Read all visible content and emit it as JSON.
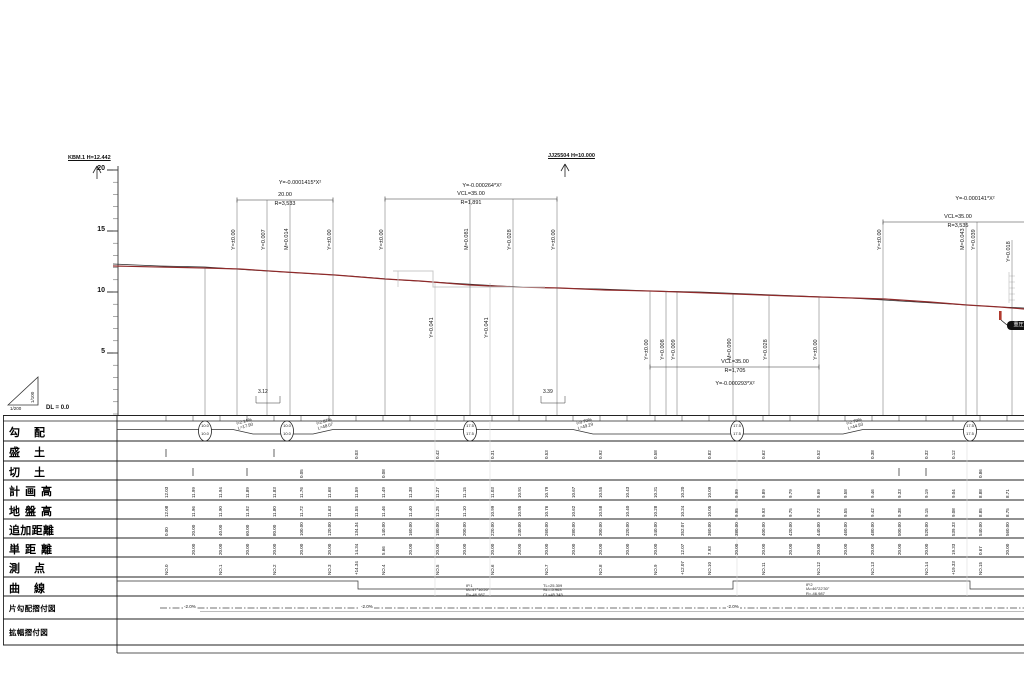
{
  "axis": {
    "dl_label": "DL = 0.0",
    "unit_ticks": [
      {
        "label": "20",
        "y": 170
      },
      {
        "label": "15",
        "y": 231
      },
      {
        "label": "10",
        "y": 292
      },
      {
        "label": "5",
        "y": 353
      }
    ],
    "scale_vertical": "1/100",
    "scale_horizontal": "1/200"
  },
  "benchmarks": [
    {
      "text": "KBM.1 H=12.442",
      "x": 68,
      "y": 155,
      "sym_x": 97
    },
    {
      "text": "JJ25504 H=10.000",
      "x": 548,
      "y": 153,
      "sym_x": 565
    }
  ],
  "curve_groups": [
    {
      "formula": "Y=-0.0001415*X²",
      "len_label": "20.00",
      "radius_label": "R=3,533",
      "cx": 285,
      "formula_x": 300,
      "formula_y": 180,
      "dim_y": 200,
      "x1": 237,
      "x2": 333
    },
    {
      "formula": "Y=-0.000264*X²",
      "len_label": "VCL=35.00",
      "radius_label": "R=1,891",
      "cx": 471,
      "formula_x": 482,
      "formula_y": 183,
      "dim_y": 199,
      "x1": 385,
      "x2": 557
    },
    {
      "formula": "Y=-0.000293*X²",
      "len_label": "VCL=35.00",
      "radius_label": "R=1,705",
      "cx": 735,
      "formula_x": 735,
      "formula_y": 381,
      "dim_y": 367,
      "x1": 650,
      "x2": 819
    },
    {
      "formula": "Y=-0.000141*X²",
      "len_label": "VCL=35.00",
      "radius_label": "R=3,535",
      "cx": 958,
      "formula_x": 975,
      "formula_y": 196,
      "dim_y": 222,
      "x1": 883,
      "x2": 1026
    }
  ],
  "rotated_labels": [
    {
      "x": 237,
      "y": 250,
      "text": "Y=±0.00"
    },
    {
      "x": 267,
      "y": 250,
      "text": "Y=0.007"
    },
    {
      "x": 290,
      "y": 250,
      "text": "M=0.014"
    },
    {
      "x": 333,
      "y": 250,
      "text": "Y=±0.00"
    },
    {
      "x": 385,
      "y": 250,
      "text": "Y=±0.00"
    },
    {
      "x": 470,
      "y": 250,
      "text": "M=0.081"
    },
    {
      "x": 513,
      "y": 250,
      "text": "Y=0.028"
    },
    {
      "x": 557,
      "y": 250,
      "text": "Y=±0.00"
    },
    {
      "x": 435,
      "y": 338,
      "text": "Y=0.041"
    },
    {
      "x": 490,
      "y": 338,
      "text": "Y=0.041"
    },
    {
      "x": 650,
      "y": 360,
      "text": "Y=±0.00"
    },
    {
      "x": 666,
      "y": 360,
      "text": "Y=0.008"
    },
    {
      "x": 677,
      "y": 360,
      "text": "Y=0.009"
    },
    {
      "x": 733,
      "y": 360,
      "text": "M=0.090"
    },
    {
      "x": 769,
      "y": 360,
      "text": "Y=0.028"
    },
    {
      "x": 819,
      "y": 360,
      "text": "Y=±0.00"
    },
    {
      "x": 883,
      "y": 250,
      "text": "Y=±0.00"
    },
    {
      "x": 966,
      "y": 250,
      "text": "M=0.043"
    },
    {
      "x": 977,
      "y": 250,
      "text": "Y=0.039"
    },
    {
      "x": 1012,
      "y": 262,
      "text": "Y=0.018"
    }
  ],
  "depth_marks": [
    {
      "x": 258,
      "y": 389,
      "text": "3.12",
      "x1": 256,
      "x2": 280
    },
    {
      "x": 543,
      "y": 389,
      "text": "3.39",
      "x1": 541,
      "x2": 565
    }
  ],
  "pipe_label": "重圧管",
  "table": {
    "row_labels": [
      "勾配",
      "盛土",
      "切土",
      "計画高",
      "地盤高",
      "追加距離",
      "単距離",
      "測点",
      "曲線",
      "片勾配摺付図",
      "拡幅摺付図"
    ],
    "gradient_ovals": [
      {
        "x": 205,
        "top": "10.0",
        "bottom": "10.0"
      },
      {
        "x": 287,
        "top": "10.0",
        "bottom": "10.0"
      },
      {
        "x": 470,
        "top": "17.5",
        "bottom": "17.5"
      },
      {
        "x": 737,
        "top": "17.5",
        "bottom": "17.5"
      },
      {
        "x": 970,
        "top": "17.5",
        "bottom": "17.5"
      }
    ],
    "gradient_segments": [
      {
        "x": 236,
        "line1": "i=2.14%",
        "line2": "L=17.90"
      },
      {
        "x": 316,
        "line1": "i=2.87%",
        "line2": "L=48.07"
      },
      {
        "x": 576,
        "line1": "i=0.70%",
        "line2": "L=49.29"
      },
      {
        "x": 846,
        "line1": "i=2.79%",
        "line2": "L=44.93"
      }
    ],
    "curve_clusters": [
      {
        "x": 466,
        "y": 584,
        "lines": [
          "IP.1",
          "IA=47°16'20\"",
          "R=-46.987"
        ]
      },
      {
        "x": 543,
        "y": 584,
        "lines": [
          "TL=25.309",
          "SL=-5.963",
          "CL=45.345"
        ]
      },
      {
        "x": 806,
        "y": 583,
        "lines": [
          "IP.2",
          "IA=46°22'30\"",
          "R=-46.987"
        ]
      }
    ],
    "superelevation_labels": [
      {
        "x": 183,
        "text": "-2.0%"
      },
      {
        "x": 360,
        "text": "-2.0%"
      },
      {
        "x": 726,
        "text": "-2.0%"
      }
    ],
    "stations": [
      {
        "x": 166,
        "sta": "NO.0",
        "dist": "",
        "cum": "0.00",
        "plan": "12.03",
        "ground": "12.08",
        "fill": "|",
        "cut": ""
      },
      {
        "x": 193,
        "sta": "",
        "dist": "20.00",
        "cum": "20.00",
        "plan": "11.99",
        "ground": "11.96",
        "fill": "",
        "cut": "|"
      },
      {
        "x": 220,
        "sta": "NO.1",
        "dist": "20.00",
        "cum": "40.00",
        "plan": "11.94",
        "ground": "11.90",
        "fill": "",
        "cut": ""
      },
      {
        "x": 247,
        "sta": "",
        "dist": "20.00",
        "cum": "60.00",
        "plan": "11.89",
        "ground": "11.92",
        "fill": "",
        "cut": "|"
      },
      {
        "x": 274,
        "sta": "NO.2",
        "dist": "20.00",
        "cum": "80.00",
        "plan": "11.83",
        "ground": "11.80",
        "fill": "|",
        "cut": ""
      },
      {
        "x": 301,
        "sta": "",
        "dist": "20.00",
        "cum": "100.00",
        "plan": "11.76",
        "ground": "11.72",
        "fill": "",
        "cut": "0.05"
      },
      {
        "x": 329,
        "sta": "NO.3",
        "dist": "20.00",
        "cum": "120.00",
        "plan": "11.68",
        "ground": "11.63",
        "fill": "",
        "cut": ""
      },
      {
        "x": 356,
        "sta": "+14.34",
        "dist": "14.34",
        "cum": "134.34",
        "plan": "11.59",
        "ground": "11.55",
        "fill": "0.03",
        "cut": ""
      },
      {
        "x": 383,
        "sta": "NO.4",
        "dist": "5.66",
        "cum": "140.00",
        "plan": "11.49",
        "ground": "11.46",
        "fill": "",
        "cut": "0.08"
      },
      {
        "x": 410,
        "sta": "",
        "dist": "20.00",
        "cum": "160.00",
        "plan": "11.38",
        "ground": "11.40",
        "fill": "",
        "cut": ""
      },
      {
        "x": 437,
        "sta": "NO.5",
        "dist": "20.00",
        "cum": "180.00",
        "plan": "11.27",
        "ground": "11.25",
        "fill": "0.42",
        "cut": ""
      },
      {
        "x": 464,
        "sta": "",
        "dist": "20.00",
        "cum": "200.00",
        "plan": "11.15",
        "ground": "11.10",
        "fill": "",
        "cut": ""
      },
      {
        "x": 492,
        "sta": "NO.6",
        "dist": "20.00",
        "cum": "220.00",
        "plan": "11.03",
        "ground": "10.99",
        "fill": "0.31",
        "cut": ""
      },
      {
        "x": 519,
        "sta": "",
        "dist": "20.00",
        "cum": "240.00",
        "plan": "10.91",
        "ground": "10.95",
        "fill": "",
        "cut": ""
      },
      {
        "x": 546,
        "sta": "NO.7",
        "dist": "20.00",
        "cum": "260.00",
        "plan": "10.79",
        "ground": "10.76",
        "fill": "0.53",
        "cut": ""
      },
      {
        "x": 573,
        "sta": "",
        "dist": "20.00",
        "cum": "280.00",
        "plan": "10.67",
        "ground": "10.62",
        "fill": "",
        "cut": ""
      },
      {
        "x": 600,
        "sta": "NO.8",
        "dist": "20.00",
        "cum": "300.00",
        "plan": "10.55",
        "ground": "10.58",
        "fill": "0.92",
        "cut": ""
      },
      {
        "x": 627,
        "sta": "",
        "dist": "20.00",
        "cum": "320.00",
        "plan": "10.43",
        "ground": "10.40",
        "fill": "",
        "cut": ""
      },
      {
        "x": 655,
        "sta": "NO.9",
        "dist": "20.00",
        "cum": "340.00",
        "plan": "10.31",
        "ground": "10.28",
        "fill": "0.58",
        "cut": ""
      },
      {
        "x": 682,
        "sta": "+12.07",
        "dist": "12.07",
        "cum": "352.07",
        "plan": "10.20",
        "ground": "10.24",
        "fill": "",
        "cut": ""
      },
      {
        "x": 709,
        "sta": "NO.10",
        "dist": "7.93",
        "cum": "360.00",
        "plan": "10.09",
        "ground": "10.05",
        "fill": "0.82",
        "cut": ""
      },
      {
        "x": 736,
        "sta": "",
        "dist": "20.00",
        "cum": "380.00",
        "plan": "9.99",
        "ground": "9.95",
        "fill": "",
        "cut": ""
      },
      {
        "x": 763,
        "sta": "NO.11",
        "dist": "20.00",
        "cum": "400.00",
        "plan": "9.89",
        "ground": "9.93",
        "fill": "0.62",
        "cut": ""
      },
      {
        "x": 790,
        "sta": "",
        "dist": "20.00",
        "cum": "420.00",
        "plan": "9.79",
        "ground": "9.75",
        "fill": "",
        "cut": ""
      },
      {
        "x": 818,
        "sta": "NO.12",
        "dist": "20.00",
        "cum": "440.00",
        "plan": "9.69",
        "ground": "9.72",
        "fill": "0.52",
        "cut": ""
      },
      {
        "x": 845,
        "sta": "",
        "dist": "20.00",
        "cum": "460.00",
        "plan": "9.58",
        "ground": "9.55",
        "fill": "",
        "cut": ""
      },
      {
        "x": 872,
        "sta": "NO.13",
        "dist": "20.00",
        "cum": "480.00",
        "plan": "9.46",
        "ground": "9.42",
        "fill": "0.38",
        "cut": ""
      },
      {
        "x": 899,
        "sta": "",
        "dist": "20.00",
        "cum": "500.00",
        "plan": "9.33",
        "ground": "9.38",
        "fill": "",
        "cut": "|"
      },
      {
        "x": 926,
        "sta": "NO.14",
        "dist": "20.00",
        "cum": "520.00",
        "plan": "9.19",
        "ground": "9.15",
        "fill": "0.32",
        "cut": "|"
      },
      {
        "x": 953,
        "sta": "+19.33",
        "dist": "19.33",
        "cum": "539.33",
        "plan": "9.04",
        "ground": "9.08",
        "fill": "0.12",
        "cut": ""
      },
      {
        "x": 980,
        "sta": "NO.15",
        "dist": "0.67",
        "cum": "540.00",
        "plan": "8.88",
        "ground": "8.85",
        "fill": "",
        "cut": "0.86"
      },
      {
        "x": 1007,
        "sta": "",
        "dist": "20.00",
        "cum": "560.00",
        "plan": "8.71",
        "ground": "8.75",
        "fill": "",
        "cut": ""
      }
    ]
  }
}
